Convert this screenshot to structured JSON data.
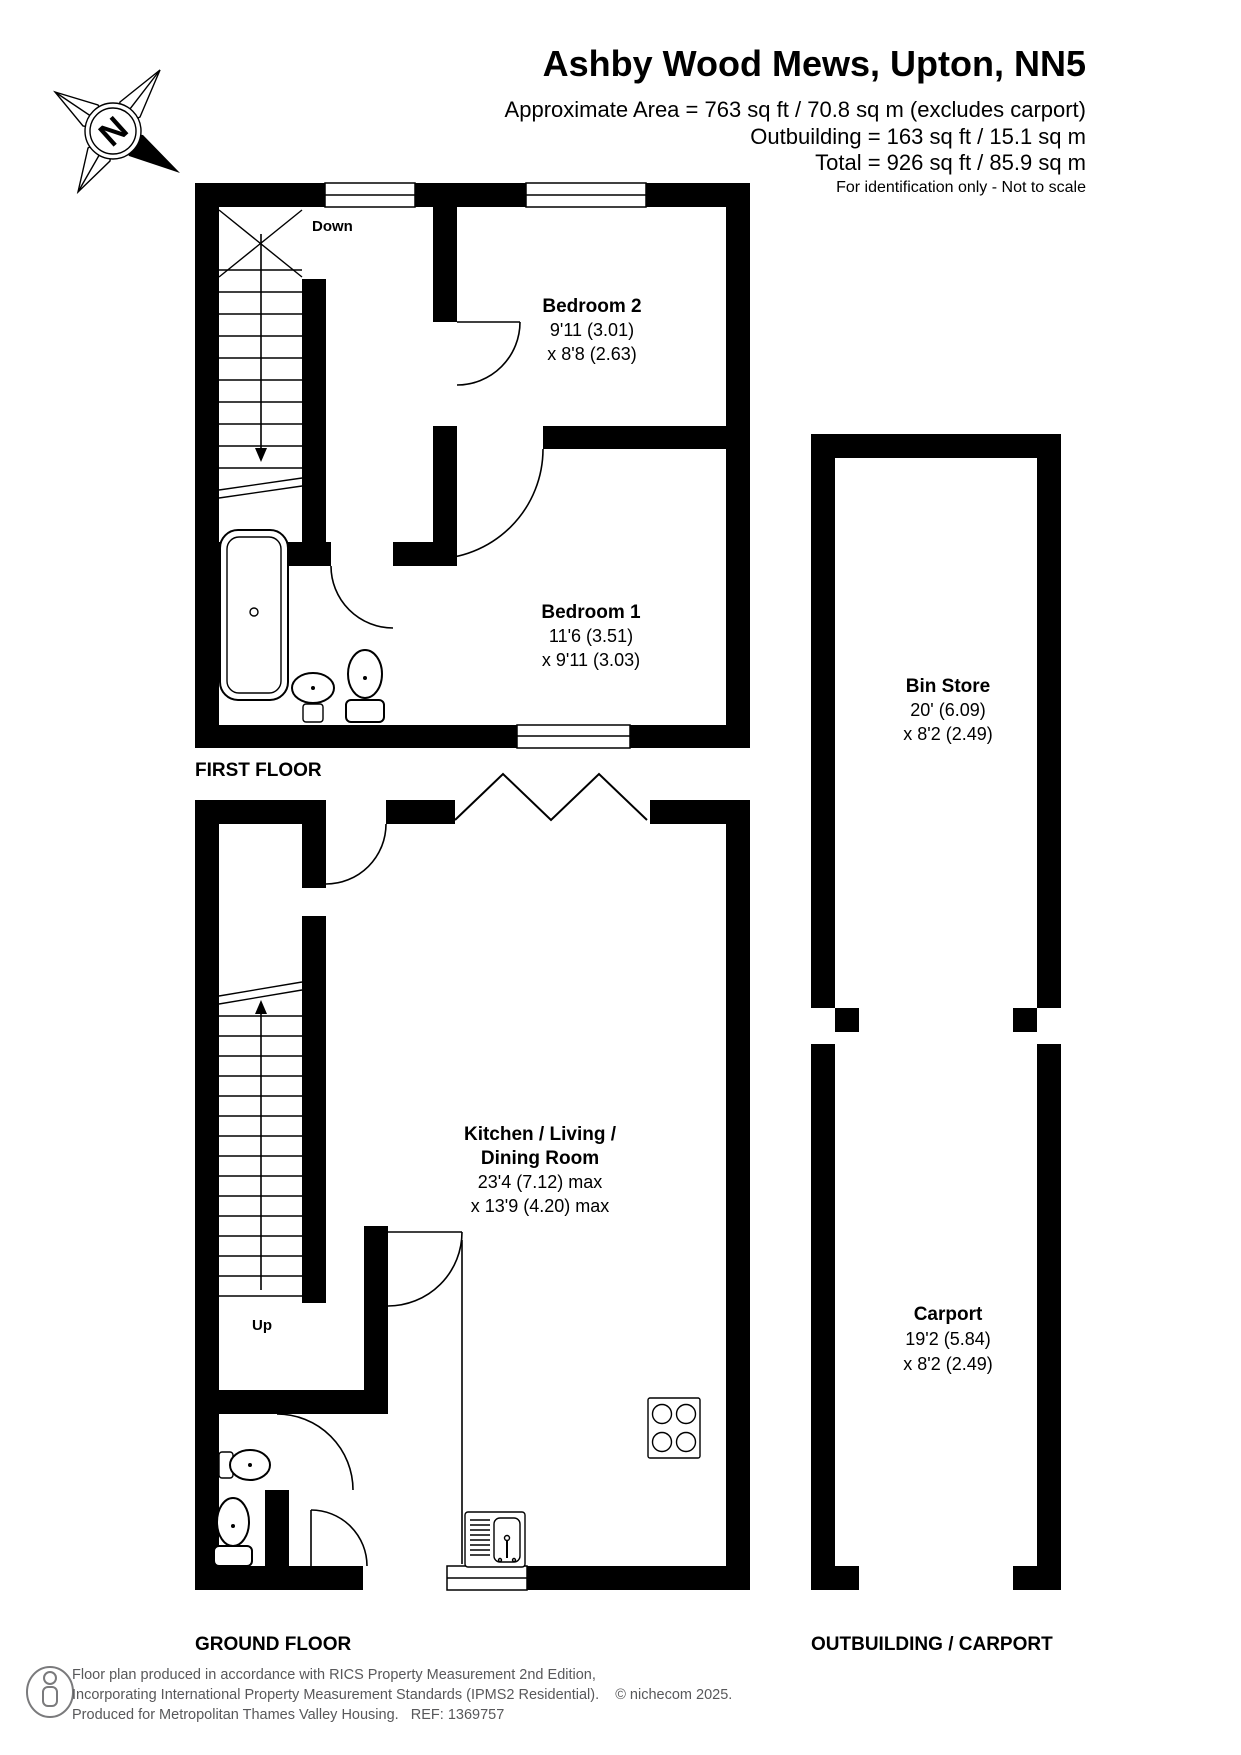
{
  "header": {
    "title": "Ashby Wood Mews, Upton, NN5",
    "area_line": "Approximate Area = 763 sq ft / 70.8 sq m (excludes carport)",
    "outbuilding_line": "Outbuilding = 163 sq ft / 15.1 sq m",
    "total_line": "Total = 926 sq ft / 85.9 sq m",
    "disclaimer": "For identification only - Not to scale"
  },
  "compass": {
    "north_label": "N"
  },
  "first_floor": {
    "floor_label": "FIRST FLOOR",
    "stairs_label": "Down",
    "bedroom2": {
      "name": "Bedroom 2",
      "dim1": "9'11 (3.01)",
      "dim2": "x 8'8 (2.63)"
    },
    "bedroom1": {
      "name": "Bedroom 1",
      "dim1": "11'6 (3.51)",
      "dim2": "x 9'11 (3.03)"
    }
  },
  "ground_floor": {
    "floor_label": "GROUND FLOOR",
    "stairs_label": "Up",
    "kitchen": {
      "name1": "Kitchen / Living /",
      "name2": "Dining Room",
      "dim1": "23'4 (7.12) max",
      "dim2": "x 13'9 (4.20) max"
    }
  },
  "outbuilding": {
    "floor_label": "OUTBUILDING / CARPORT",
    "bin_store": {
      "name": "Bin Store",
      "dim1": "20' (6.09)",
      "dim2": "x 8'2 (2.49)"
    },
    "carport": {
      "name": "Carport",
      "dim1": "19'2 (5.84)",
      "dim2": "x 8'2 (2.49)"
    }
  },
  "footer": {
    "line1": "Floor plan produced in accordance with RICS Property Measurement 2nd Edition,",
    "line2": "Incorporating International Property Measurement Standards (IPMS2 Residential).    © nichecom 2025.",
    "line3": "Produced for Metropolitan Thames Valley Housing.   REF: 1369757"
  },
  "colors": {
    "wall": "#000000",
    "footer_text": "#58585a"
  }
}
